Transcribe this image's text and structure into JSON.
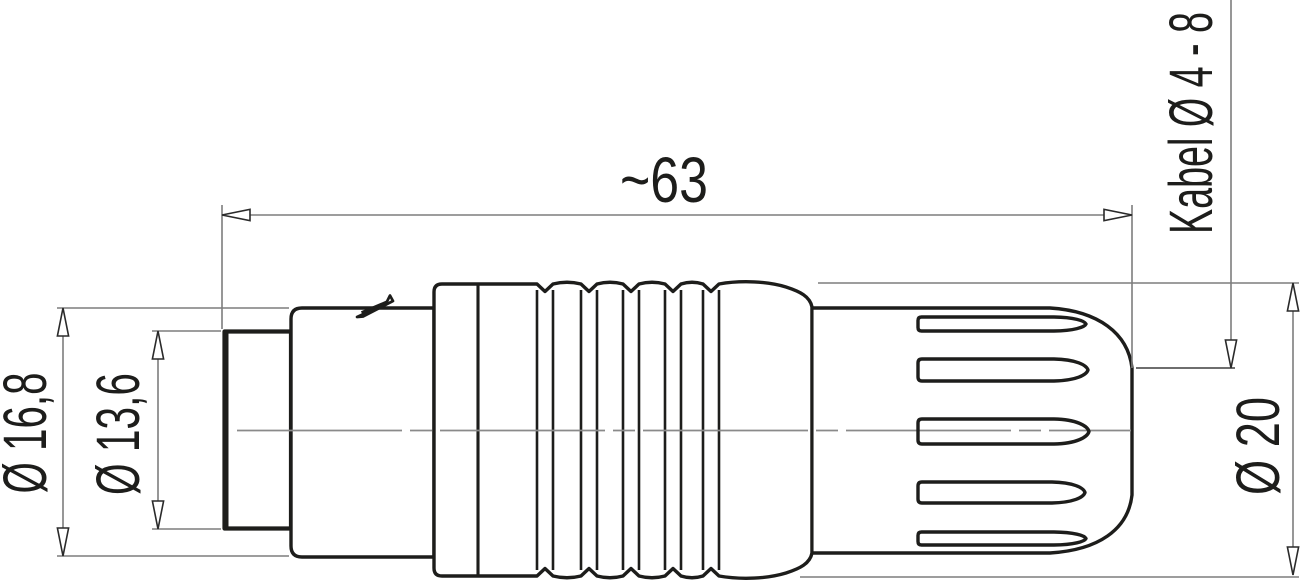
{
  "labels": {
    "overall_length": "~63",
    "body_diameter": "Ø 16,8",
    "front_diameter": "Ø 13,6",
    "grip_diameter": "Ø 20",
    "cable_diameter": "Kabel Ø 4 - 8"
  },
  "colors": {
    "outline": "#1d1d1b",
    "dimension_line": "#7d7d7d",
    "centerline": "#8a8a8a",
    "arrow_stroke": "#2a2a2a",
    "background": "#ffffff"
  }
}
